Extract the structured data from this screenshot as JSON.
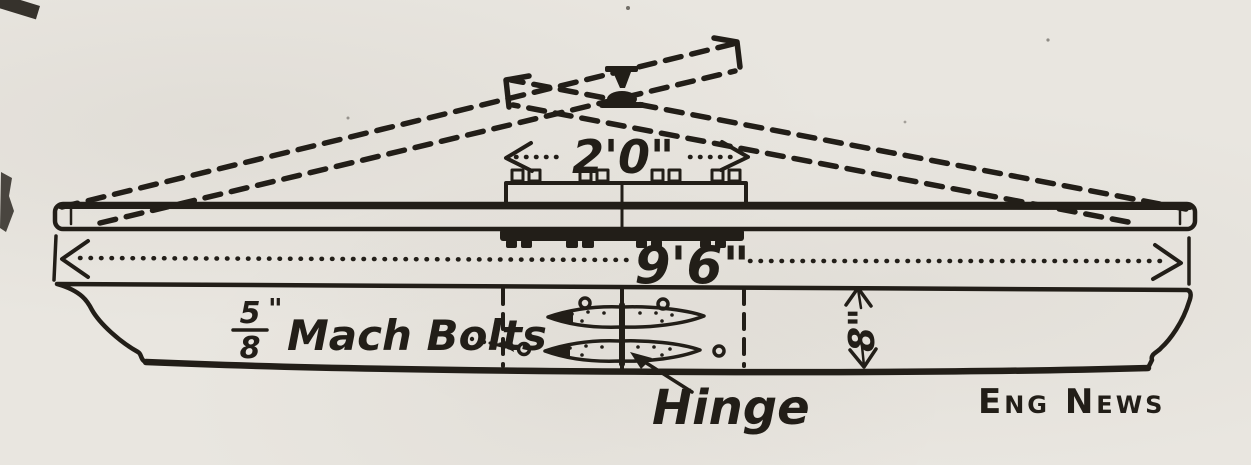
{
  "drawing": {
    "dimensions": {
      "plate_length": "2'0\"",
      "overall_length": "9'6\"",
      "plank_width": "8\""
    },
    "annotations": {
      "bolts_numerator": "5",
      "bolts_denominator": "8",
      "bolts_inch_mark": "\"",
      "bolts_label": "Mach Bolts",
      "hinge_label": "Hinge",
      "credit": "Eng News"
    },
    "colors": {
      "ink": "#221e18",
      "paper": "#e9e6e0"
    }
  }
}
